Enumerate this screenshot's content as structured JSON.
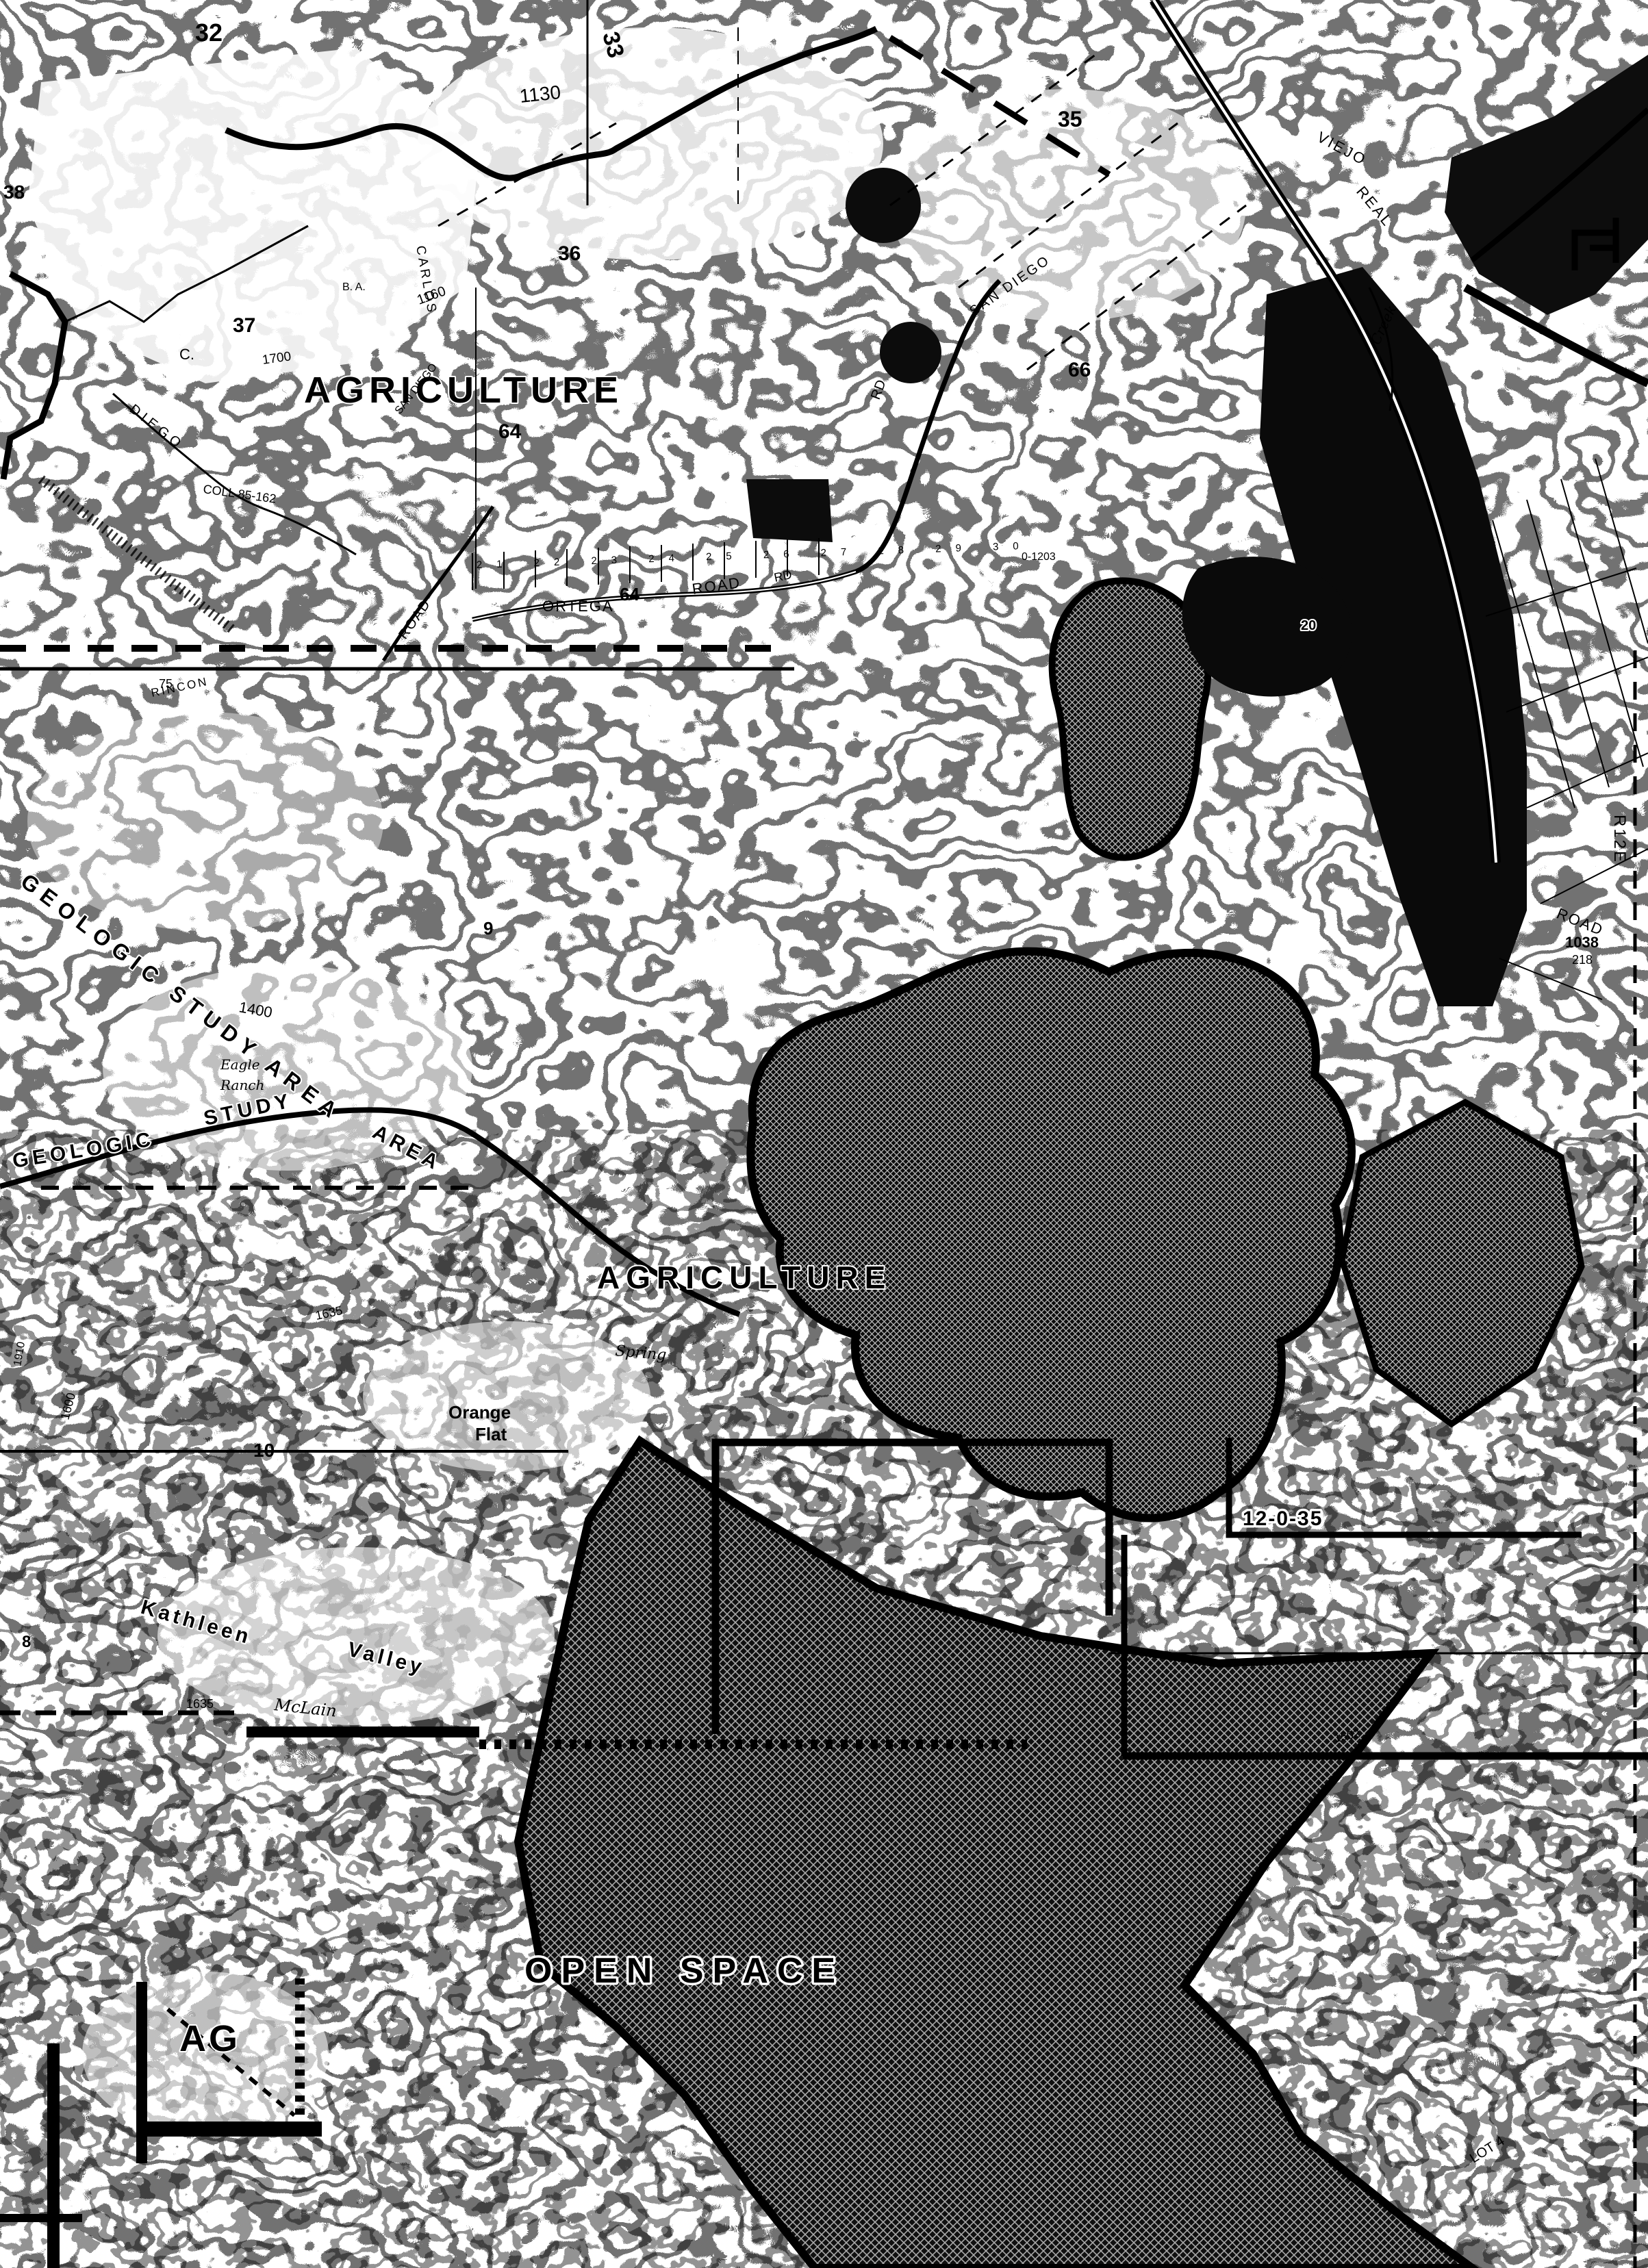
{
  "map": {
    "palette": {
      "ink": "#000000",
      "paper": "#ffffff"
    },
    "labels": [
      {
        "text": "32"
      },
      {
        "text": "33"
      },
      {
        "text": "1130"
      },
      {
        "text": "38"
      },
      {
        "text": "37"
      },
      {
        "text": "36"
      },
      {
        "text": "35"
      },
      {
        "text": "C."
      },
      {
        "text": "DIEGO"
      },
      {
        "text": "COLL 85-162"
      },
      {
        "text": "B. A."
      },
      {
        "text": "AGRICULTURE"
      },
      {
        "text": "64"
      },
      {
        "text": "CARLOS"
      },
      {
        "text": "1160"
      },
      {
        "text": "1700"
      },
      {
        "text": "SAN DIEGO"
      },
      {
        "text": "SAN DIEGO"
      },
      {
        "text": "VIEJO"
      },
      {
        "text": "REAL"
      },
      {
        "text": "66"
      },
      {
        "text": "Creek"
      },
      {
        "text": "RD"
      },
      {
        "text": "ORTEGA"
      },
      {
        "text": "64"
      },
      {
        "text": "ROAD"
      },
      {
        "text": "RD"
      },
      {
        "text": "21 22 23 24 25 26 27 28 29 30"
      },
      {
        "text": "ROAD"
      },
      {
        "text": "0-1203"
      },
      {
        "text": "GEOLOGIC STUDY AREA"
      },
      {
        "text": "1400"
      },
      {
        "text": "Eagle"
      },
      {
        "text": "Ranch"
      },
      {
        "text": "GEOLOGIC"
      },
      {
        "text": "STUDY"
      },
      {
        "text": "AREA"
      },
      {
        "text": "RINCON"
      },
      {
        "text": "9"
      },
      {
        "text": "75"
      },
      {
        "text": "AGRICULTURE"
      },
      {
        "text": "Spring"
      },
      {
        "text": "1635"
      },
      {
        "text": "Orange"
      },
      {
        "text": "Flat"
      },
      {
        "text": "10"
      },
      {
        "text": "1600"
      },
      {
        "text": "1910"
      },
      {
        "text": "Kathleen"
      },
      {
        "text": "Valley"
      },
      {
        "text": "McLain"
      },
      {
        "text": "1635"
      },
      {
        "text": "8"
      },
      {
        "text": "1502"
      },
      {
        "text": "12-0-35"
      },
      {
        "text": "OPEN SPACE"
      },
      {
        "text": "AG"
      },
      {
        "text": "R12E"
      },
      {
        "text": "ROAD"
      },
      {
        "text": "1038"
      },
      {
        "text": "218"
      },
      {
        "text": "LOT 4"
      },
      {
        "text": "20"
      }
    ]
  }
}
